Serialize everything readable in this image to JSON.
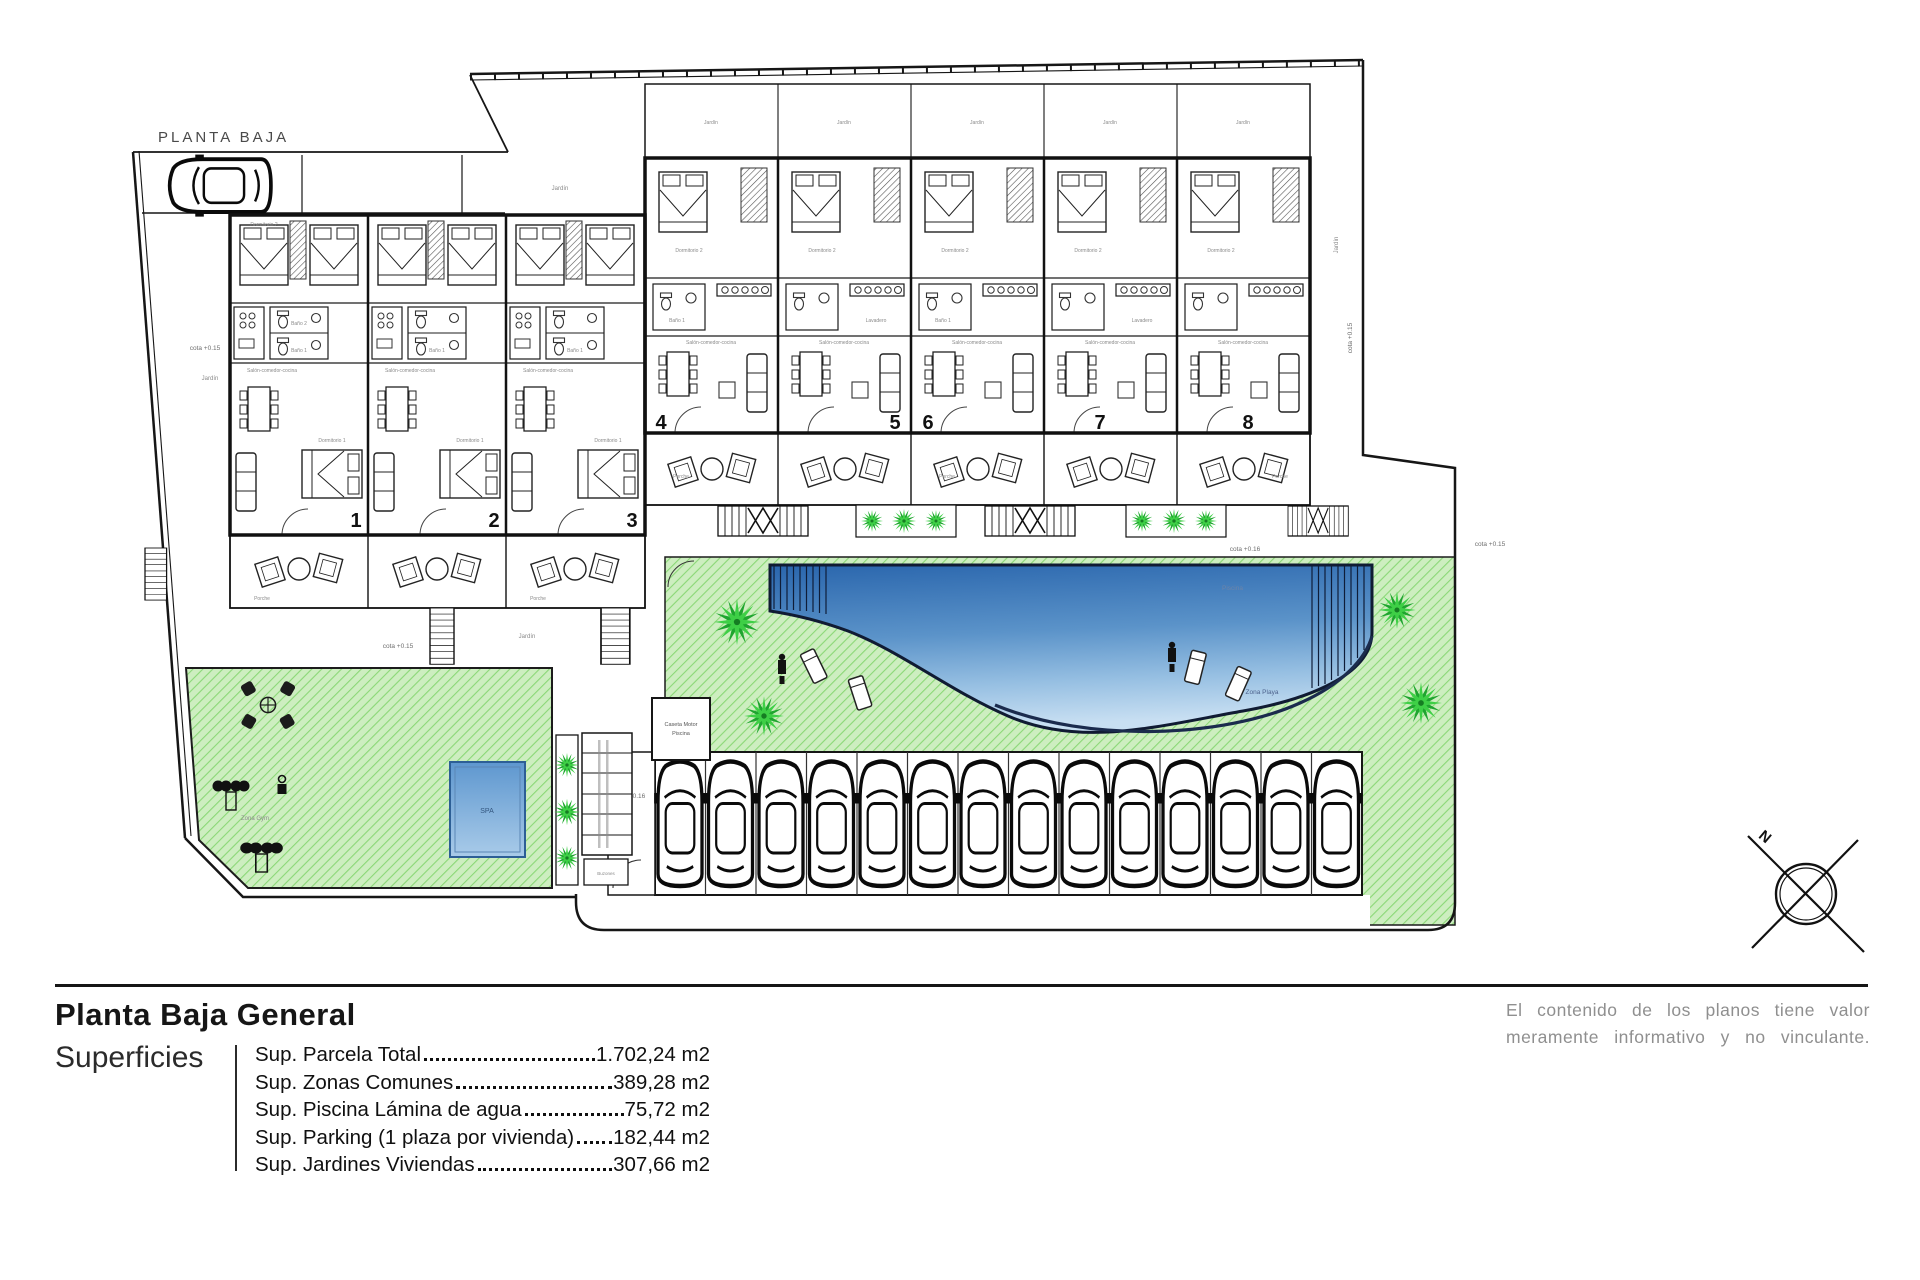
{
  "plan": {
    "title": "PLANTA BAJA",
    "units": [
      "1",
      "2",
      "3",
      "4",
      "5",
      "6",
      "7",
      "8"
    ],
    "labels": {
      "jardin": "Jardín",
      "porche": "Porche",
      "piscina": "Piscina",
      "zona_playa": "Zona Playa",
      "spa": "SPA",
      "zona_gym": "Zona Gym",
      "caseta_line1": "Caseta Motor",
      "caseta_line2": "Piscina",
      "buzones": "Buzones",
      "cota_015": "cota +0.15",
      "cota_016": "cota +0.16",
      "dormitorio1": "Dormitorio 1",
      "dormitorio2": "Dormitorio 2",
      "bano1": "Baño 1",
      "bano2": "Baño 2",
      "salon": "Salón-comedor-cocina",
      "lavadero": "Lavadero",
      "north": "N"
    },
    "colors": {
      "grass": "#cdeec0",
      "grass_hatch": "#8bd877",
      "pool_deep": "#2a66ad",
      "pool_shallow": "#c8dff2",
      "palm_green": "#3ecf46",
      "line": "#161616",
      "muted_text": "#8f8f8f"
    }
  },
  "legend": {
    "title": "Planta Baja General",
    "section": "Superficies",
    "rows": [
      {
        "label": "Sup. Parcela Total ",
        "value": "1.702,24 m2"
      },
      {
        "label": "Sup. Zonas Comunes ",
        "value": "389,28 m2"
      },
      {
        "label": "Sup. Piscina Lámina de agua",
        "value": "75,72 m2"
      },
      {
        "label": "Sup. Parking (1 plaza por vivienda)",
        "value": "182,44 m2"
      },
      {
        "label": "Sup. Jardines Viviendas",
        "value": "307,66 m2"
      }
    ],
    "disclaimer_line1": "El contenido de los planos tiene valor",
    "disclaimer_line2": "meramente informativo y no vinculante."
  }
}
